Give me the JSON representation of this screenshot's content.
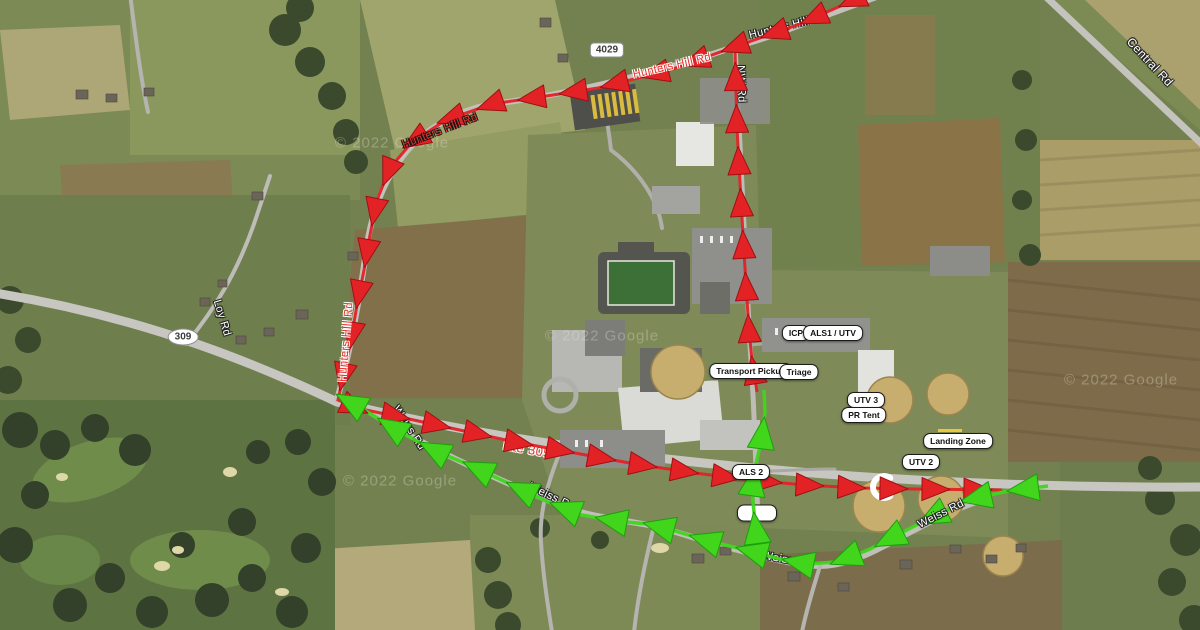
{
  "map": {
    "description": "Satellite map with incident traffic plan: red inbound route loop and green egress route with labeled emergency posts",
    "colors": {
      "route_red": "#e32226",
      "route_red_edge": "#9e1013",
      "route_green": "#41d51c",
      "route_green_edge": "#1d9e0d",
      "waypoint_bg": "#ffffff",
      "waypoint_border": "#1b1b1b",
      "road_fill": "#c6c5c0"
    }
  },
  "waypoints": [
    {
      "label": "ICP",
      "x": 796,
      "y": 333
    },
    {
      "label": "ALS1 / UTV",
      "x": 833,
      "y": 333
    },
    {
      "label": "Transport Pickup",
      "x": 751,
      "y": 371
    },
    {
      "label": "Triage",
      "x": 799,
      "y": 372
    },
    {
      "label": "UTV 3",
      "x": 866,
      "y": 400
    },
    {
      "label": "PR Tent",
      "x": 864,
      "y": 415
    },
    {
      "label": "Landing Zone",
      "x": 958,
      "y": 441
    },
    {
      "label": "UTV 2",
      "x": 921,
      "y": 462
    },
    {
      "label": "ALS 2",
      "x": 751,
      "y": 472
    },
    {
      "label": "",
      "x": 757,
      "y": 513,
      "obscured": true
    }
  ],
  "road_labels": [
    {
      "text": "Hunters Hill Rd",
      "x": 788,
      "y": 26,
      "rot": -14,
      "style": "white"
    },
    {
      "text": "Hunters Hill Rd",
      "x": 672,
      "y": 66,
      "rot": -13,
      "style": "red",
      "over": true
    },
    {
      "text": "Hunters Hill Rd",
      "x": 440,
      "y": 131,
      "rot": -21,
      "style": "red-dark",
      "over": true
    },
    {
      "text": "Hunters Hill Rd",
      "x": 346,
      "y": 342,
      "rot": -85,
      "style": "red",
      "over": true
    },
    {
      "text": "NW Rd",
      "x": 741,
      "y": 84,
      "rot": 88,
      "style": "white"
    },
    {
      "text": "Central Rd",
      "x": 1150,
      "y": 62,
      "rot": 47,
      "style": "white",
      "size": 12
    },
    {
      "text": "Loy Rd",
      "x": 222,
      "y": 318,
      "rot": 73,
      "style": "white"
    },
    {
      "text": "Rte 309",
      "x": 527,
      "y": 449,
      "rot": 10,
      "style": "red",
      "size": 13
    },
    {
      "text": "Weiss Rd",
      "x": 552,
      "y": 497,
      "rot": 26,
      "style": "white"
    },
    {
      "text": "Weiss Rd",
      "x": 409,
      "y": 428,
      "rot": 57,
      "style": "white"
    },
    {
      "text": "Weiss Rd",
      "x": 787,
      "y": 560,
      "rot": 10,
      "style": "white"
    },
    {
      "text": "Weiss Rd",
      "x": 941,
      "y": 514,
      "rot": -27,
      "style": "white",
      "over": true
    }
  ],
  "route_badges": [
    {
      "label": "4029",
      "shape": "rect",
      "x": 607,
      "y": 50
    },
    {
      "label": "309",
      "shape": "oval",
      "x": 183,
      "y": 337
    }
  ],
  "watermarks": [
    {
      "text": "© 2022 Google",
      "x": 392,
      "y": 143
    },
    {
      "text": "© 2022 Google",
      "x": 602,
      "y": 336
    },
    {
      "text": "© 2022 Google",
      "x": 400,
      "y": 481
    },
    {
      "text": "© 2022 Google",
      "x": 1121,
      "y": 380
    }
  ],
  "routes": {
    "red": {
      "color": "#e32226",
      "edge": "#9e1013",
      "line_width": 3,
      "head_len": 28,
      "head_w": 23,
      "spacing": 42,
      "paths": [
        [
          [
            872,
            -8
          ],
          [
            800,
            24
          ],
          [
            737,
            46
          ],
          [
            670,
            70
          ],
          [
            598,
            88
          ],
          [
            540,
            97
          ],
          [
            492,
            104
          ],
          [
            446,
            120
          ],
          [
            412,
            142
          ],
          [
            390,
            168
          ],
          [
            377,
            200
          ],
          [
            370,
            235
          ],
          [
            364,
            270
          ],
          [
            357,
            305
          ],
          [
            351,
            340
          ],
          [
            344,
            372
          ],
          [
            338,
            400
          ],
          [
            356,
            408
          ],
          [
            400,
            417
          ],
          [
            455,
            429
          ],
          [
            515,
            442
          ],
          [
            575,
            453
          ],
          [
            635,
            464
          ],
          [
            695,
            473
          ],
          [
            750,
            480
          ],
          [
            805,
            485
          ],
          [
            860,
            488
          ],
          [
            915,
            489
          ],
          [
            1002,
            490
          ]
        ],
        [
          [
            757,
            392
          ],
          [
            752,
            360
          ],
          [
            749,
            330
          ],
          [
            747,
            300
          ],
          [
            745,
            268
          ],
          [
            743,
            235
          ],
          [
            741,
            200
          ],
          [
            739,
            165
          ],
          [
            737,
            128
          ],
          [
            736,
            92
          ],
          [
            735,
            48
          ]
        ]
      ]
    },
    "green": {
      "color": "#41d51c",
      "edge": "#1d9e0d",
      "line_width": 3.5,
      "head_len": 32,
      "head_w": 27,
      "spacing": 48,
      "paths": [
        [
          [
            1048,
            486
          ],
          [
            1008,
            491
          ],
          [
            972,
            499
          ],
          [
            938,
            514
          ],
          [
            903,
            532
          ],
          [
            868,
            550
          ],
          [
            836,
            562
          ],
          [
            806,
            564
          ],
          [
            776,
            558
          ],
          [
            742,
            549
          ],
          [
            708,
            541
          ],
          [
            672,
            530
          ],
          [
            648,
            524
          ],
          [
            615,
            521
          ],
          [
            582,
            515
          ],
          [
            548,
            502
          ],
          [
            512,
            485
          ],
          [
            474,
            467
          ],
          [
            436,
            451
          ],
          [
            398,
            431
          ],
          [
            366,
            411
          ],
          [
            350,
            402
          ]
        ],
        [
          [
            759,
            553
          ],
          [
            755,
            522
          ],
          [
            752,
            492
          ],
          [
            756,
            464
          ],
          [
            762,
            438
          ],
          [
            765,
            412
          ],
          [
            764,
            390
          ]
        ]
      ]
    },
    "horseshoe_marker": {
      "x": 884,
      "y": 487,
      "radius": 11,
      "color": "#ffffff"
    }
  }
}
